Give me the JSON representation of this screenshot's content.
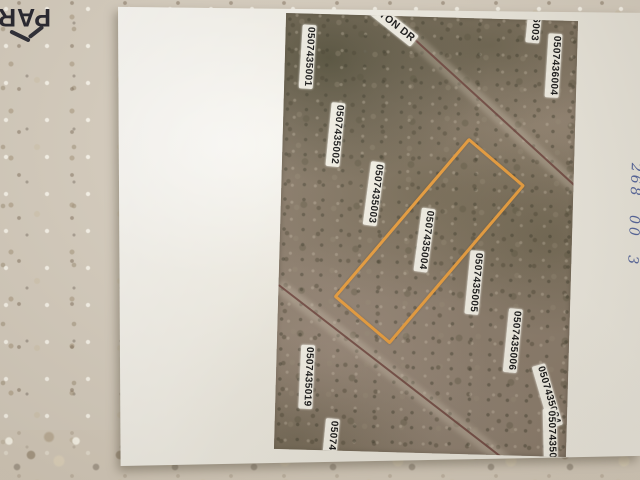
{
  "photo": {
    "counter_print_text": "PAR",
    "handwritten_note": "268 00 3"
  },
  "map": {
    "street_label": "NGTON DR",
    "highlighted_parcel": "0507435004",
    "highlight_color": "#e79b3a",
    "road_color": "#6a4038",
    "parcel_labels": [
      {
        "id": "0507435001",
        "x": 23,
        "y": 43,
        "rot": 92
      },
      {
        "id": "0507435002",
        "x": 53,
        "y": 120,
        "rot": 94
      },
      {
        "id": "0507435003",
        "x": 93,
        "y": 178,
        "rot": 96
      },
      {
        "id": "0507435004",
        "x": 145,
        "y": 223,
        "rot": 96
      },
      {
        "id": "0507435005",
        "x": 196,
        "y": 264,
        "rot": 94
      },
      {
        "id": "0507435006",
        "x": 236,
        "y": 321,
        "rot": 94
      },
      {
        "id": "6003",
        "x": 248,
        "y": 9,
        "rot": 94
      },
      {
        "id": "0507436004",
        "x": 269,
        "y": 45,
        "rot": 92
      },
      {
        "id": "0507435019",
        "x": 31,
        "y": 363,
        "rot": 91
      },
      {
        "id": "050743",
        "x": 57,
        "y": 424,
        "rot": 94
      },
      {
        "id": "0507435024",
        "x": 272,
        "y": 375,
        "rot": 72
      },
      {
        "id": "05074350",
        "x": 276,
        "y": 414,
        "rot": 87
      }
    ],
    "roads": [
      {
        "x": 75,
        "y": -24,
        "len": 300,
        "angle": 40.8
      },
      {
        "x": 0,
        "y": 272,
        "len": 290,
        "angle": 36.1
      }
    ]
  }
}
